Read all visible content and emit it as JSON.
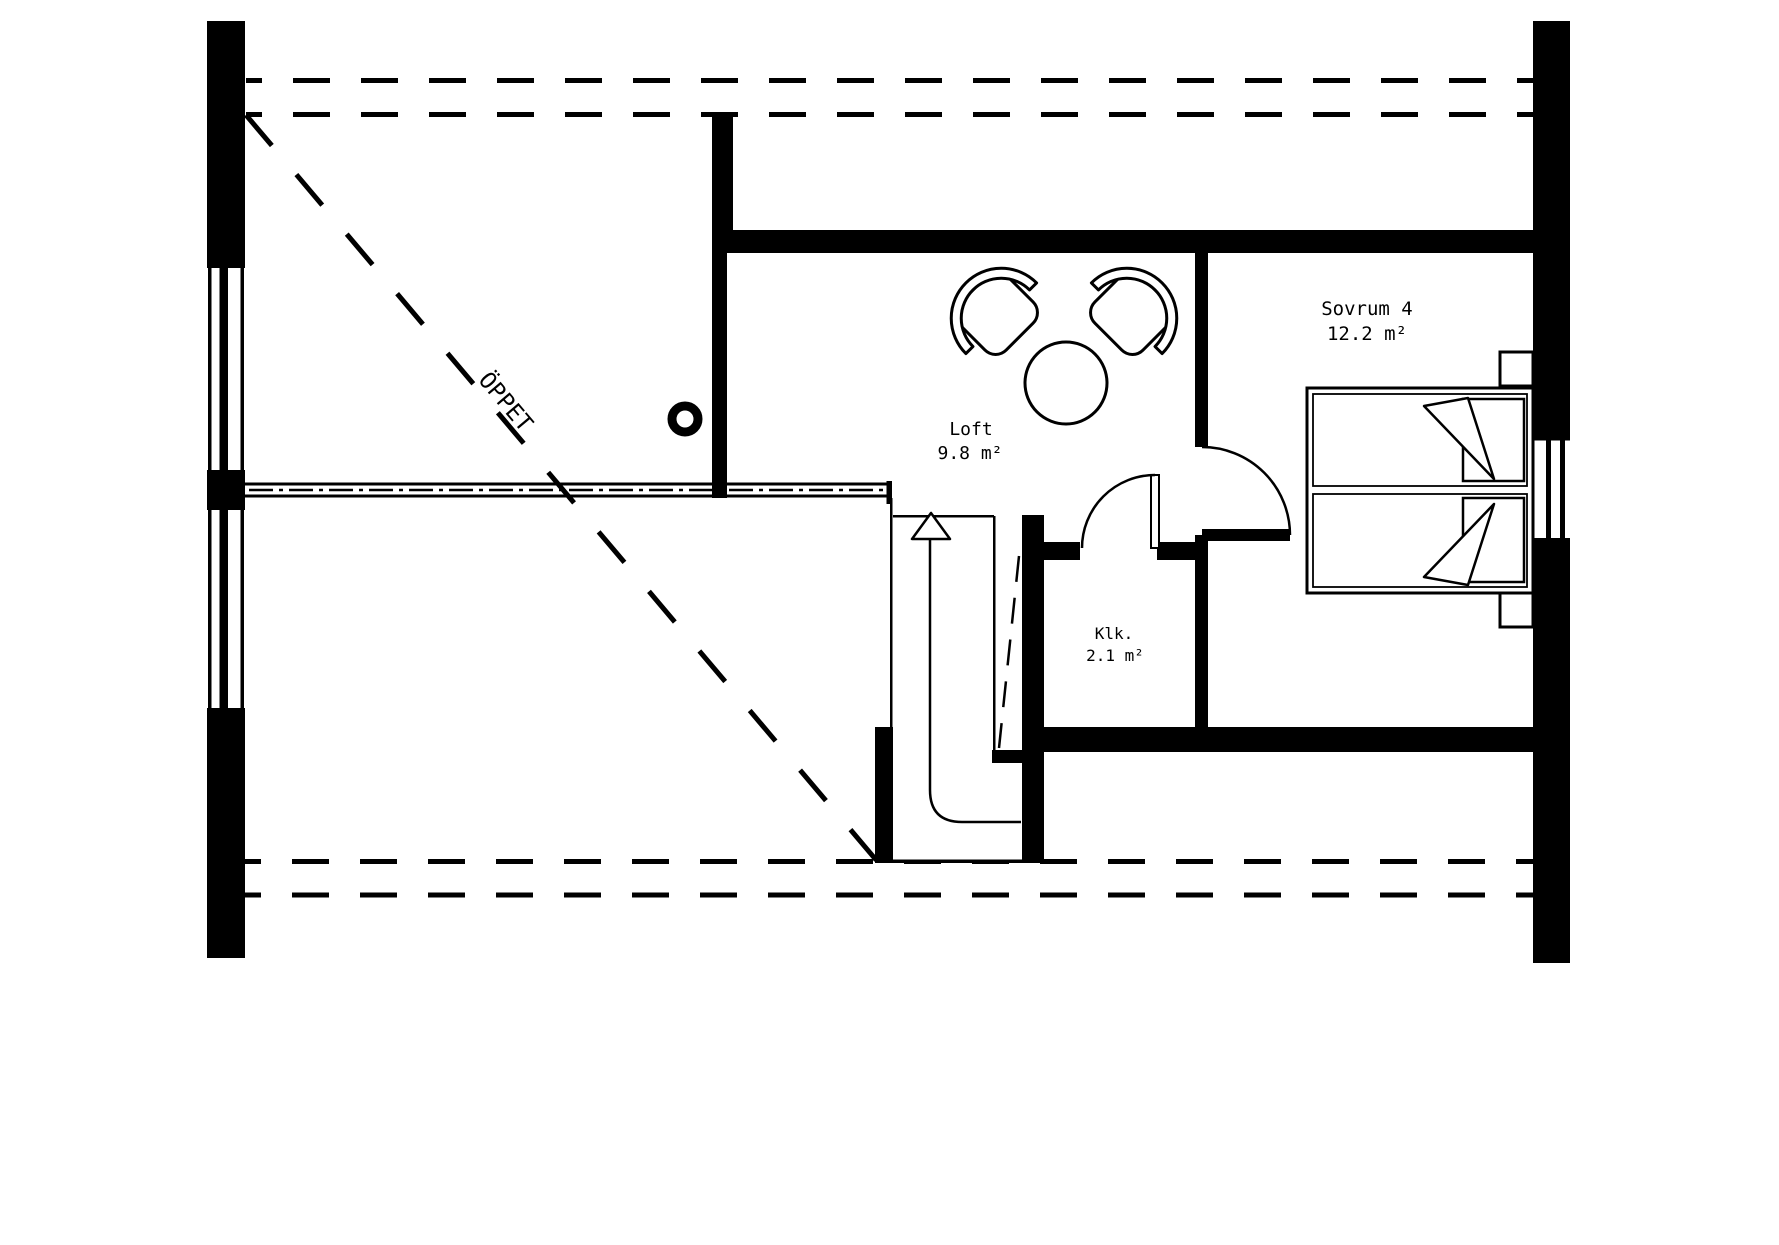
{
  "plan": {
    "open_area_label": "ÖPPET",
    "rooms": [
      {
        "name": "Loft",
        "area": "9.8 m²"
      },
      {
        "name": "Sovrum 4",
        "area": "12.2 m²"
      },
      {
        "name": "Klk.",
        "area": "2.1 m²"
      }
    ]
  },
  "colors": {
    "ink": "#000000",
    "paper": "#ffffff"
  }
}
